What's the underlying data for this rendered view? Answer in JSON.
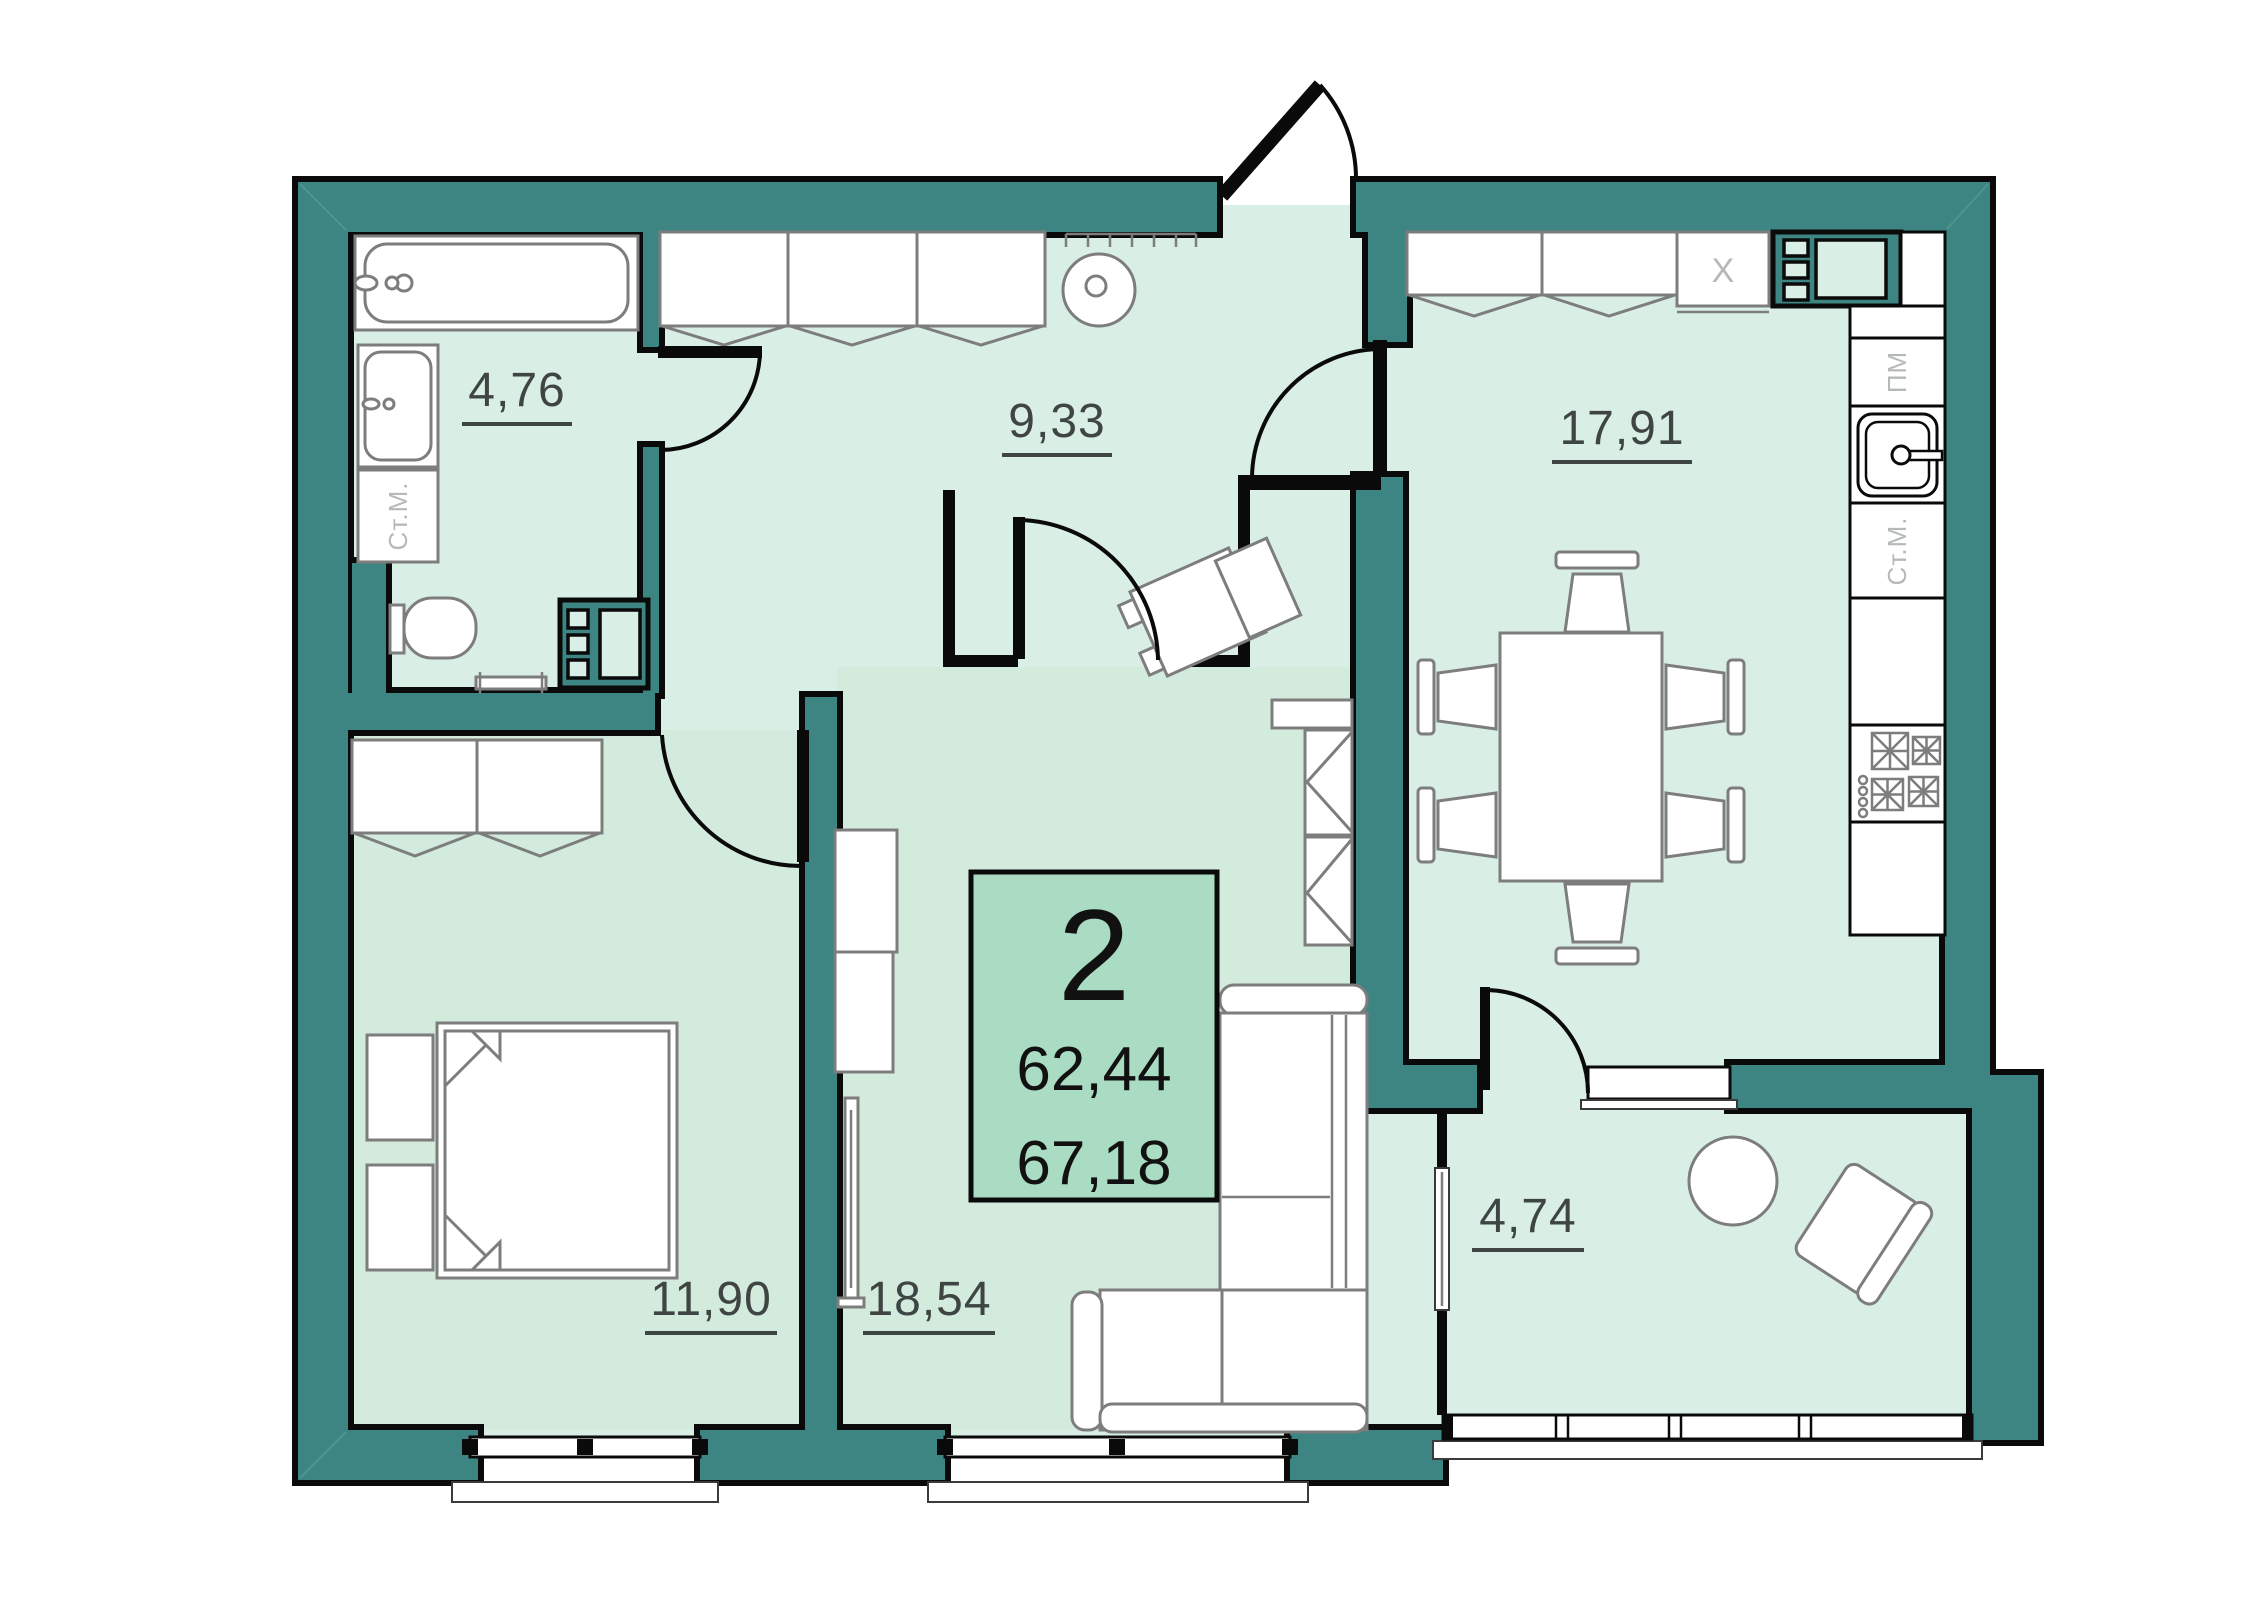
{
  "plan": {
    "type": "floor_plan",
    "info_box": {
      "unit_number": "2",
      "area_living": "62,44",
      "area_total": "67,18"
    },
    "rooms": {
      "bathroom": {
        "area": "4,76"
      },
      "hallway": {
        "area": "9,33"
      },
      "kitchen": {
        "area": "17,91"
      },
      "bedroom": {
        "area": "11,90"
      },
      "living_room": {
        "area": "18,54"
      },
      "balcony": {
        "area": "4,74"
      }
    },
    "appliances": {
      "washing_machine_bathroom": "Ст.М.",
      "washing_machine_kitchen": "Ст.М.",
      "dishwasher": "ПМ",
      "fridge": "X"
    },
    "colors": {
      "wall": "#3D8583",
      "outline": "#0A0A0A",
      "floor": "#D9EFE5",
      "floor_rooms": "#D2EBDD",
      "info_box_fill": "#A9DCC3",
      "furniture_stroke": "#7D7D7D",
      "label_text": "#3F4543",
      "appliance_text": "#B5BAB7"
    }
  }
}
